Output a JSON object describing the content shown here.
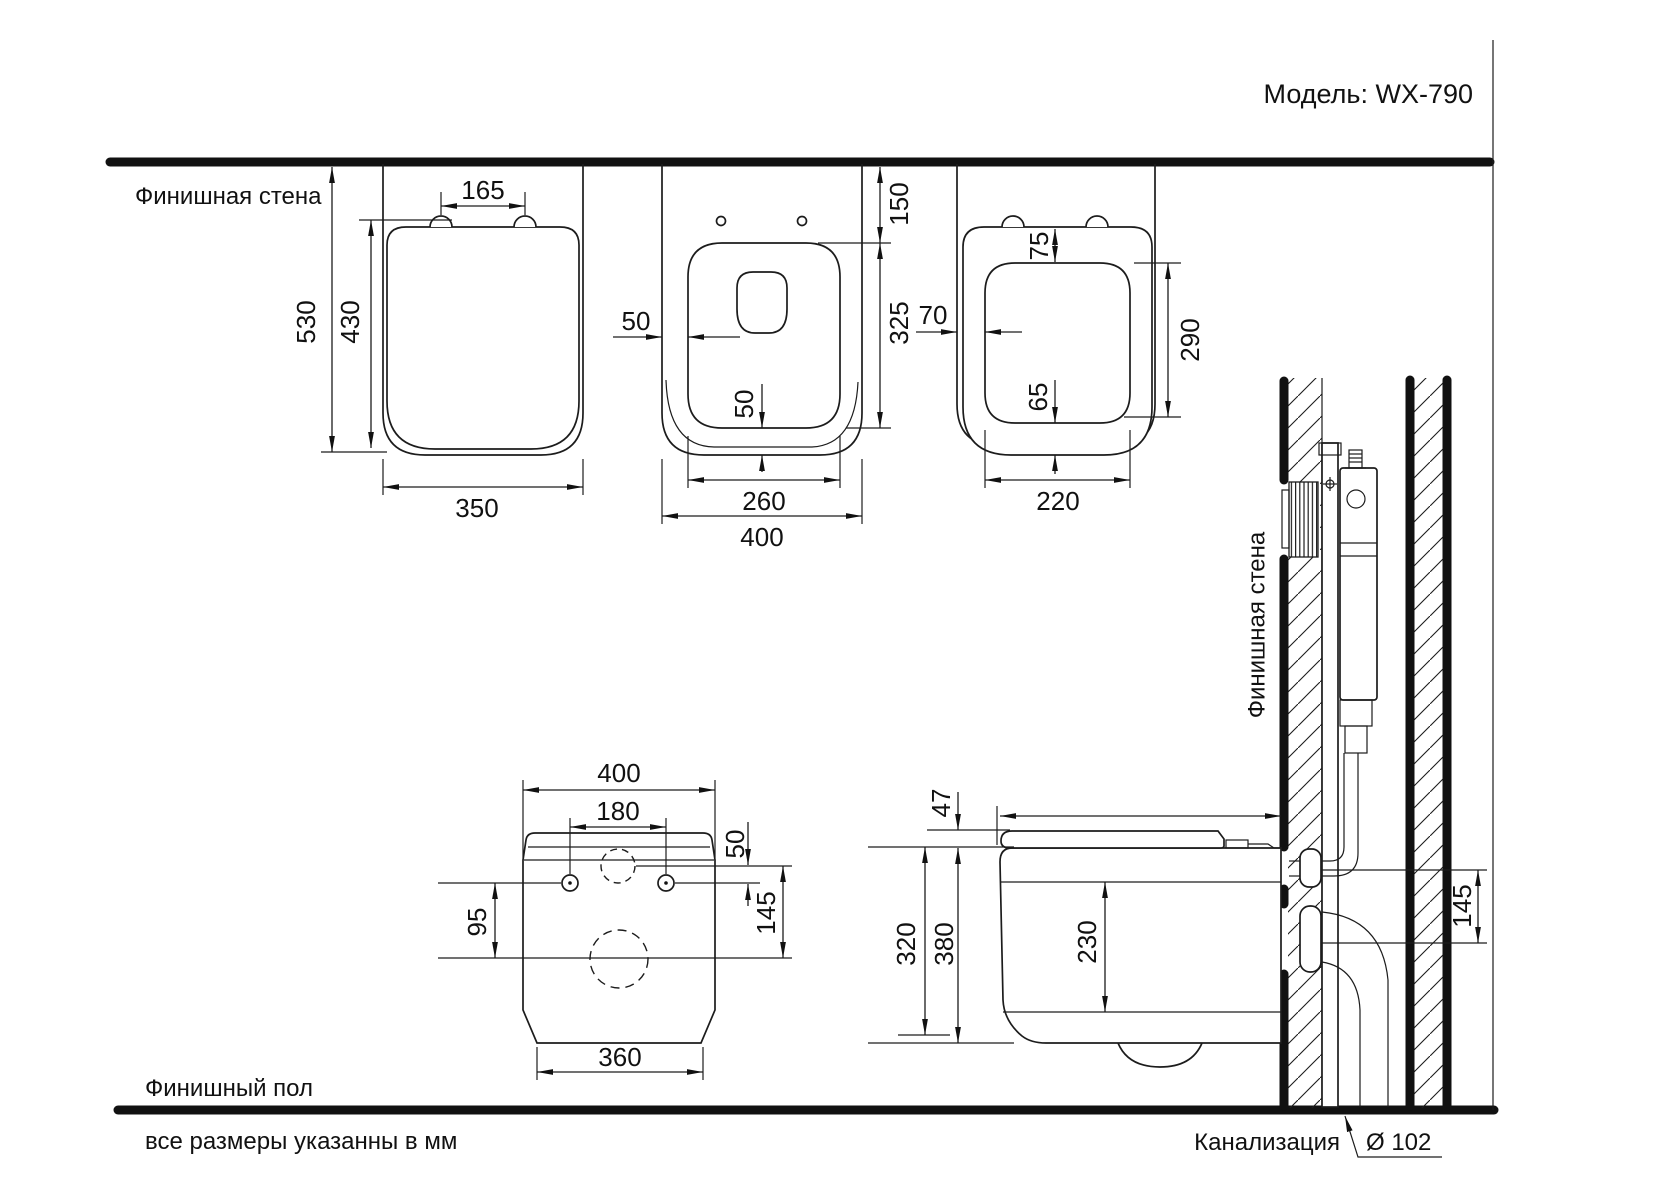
{
  "labels": {
    "model": "Модель: WX-790",
    "finished_wall": "Финишная стена",
    "finished_wall_vertical": "Финишная стена",
    "finished_floor": "Финишный пол",
    "units_note": "все размеры указанны в мм",
    "sewer": "Канализация",
    "sewer_diameter": "Ø 102"
  },
  "dims": {
    "lid_view": {
      "hinge_spacing": "165",
      "depth_total": "530",
      "lid_length": "430",
      "width": "350"
    },
    "bowl_view": {
      "rim_gap_side": "50",
      "wall_to_seat": "150",
      "seat_opening_depth": "325",
      "rim_gap_bottom": "50",
      "seat_opening_width": "260",
      "overall_width": "400"
    },
    "seat_view": {
      "gap_front": "75",
      "gap_side": "70",
      "gap_back": "65",
      "opening_depth": "290",
      "opening_width": "220"
    },
    "back_view": {
      "overall_width": "400",
      "bolt_spacing": "180",
      "inlet_to_top": "50",
      "bolts_to_drain": "95",
      "inlet_to_drain": "145",
      "base_width": "360"
    },
    "side_view": {
      "seat_stack_height": "47",
      "body_height": "320",
      "overall_height": "380",
      "front_height": "230",
      "supply_to_drain": "145"
    }
  }
}
